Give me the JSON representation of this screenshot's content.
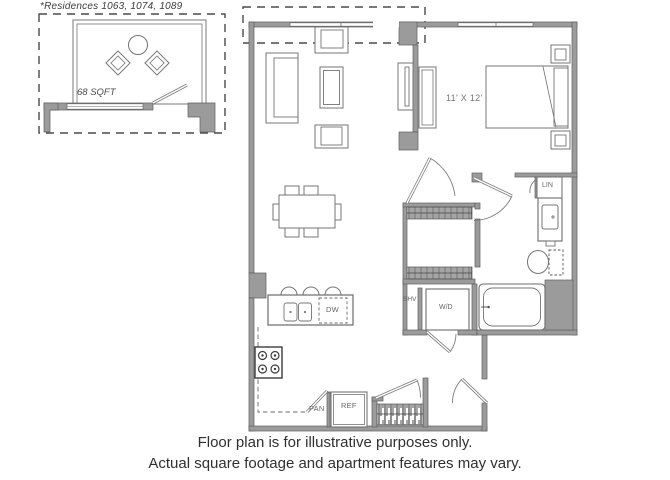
{
  "inset": {
    "note": "*Residences 1063, 1074, 1089",
    "sqft": "68 SQFT"
  },
  "labels": {
    "bedroom_dims": "11' X 12'",
    "lin": "LIN",
    "shv": "SHV",
    "wd": "W/D",
    "dw": "DW",
    "pan": "PAN",
    "ref": "REF"
  },
  "footer": {
    "line1": "Floor plan is for illustrative purposes only.",
    "line2": "Actual square footage and apartment features may vary."
  },
  "colors": {
    "background": "#ffffff",
    "wall_fill": "#9b9b9b",
    "wall_stroke": "#5e5e5e",
    "furniture_stroke": "#757575",
    "hatch_marks": "#1c1c1c",
    "dashed_outline": "#4a4a4a",
    "label_text": "#6a6a6a",
    "footer_text": "#303030"
  }
}
